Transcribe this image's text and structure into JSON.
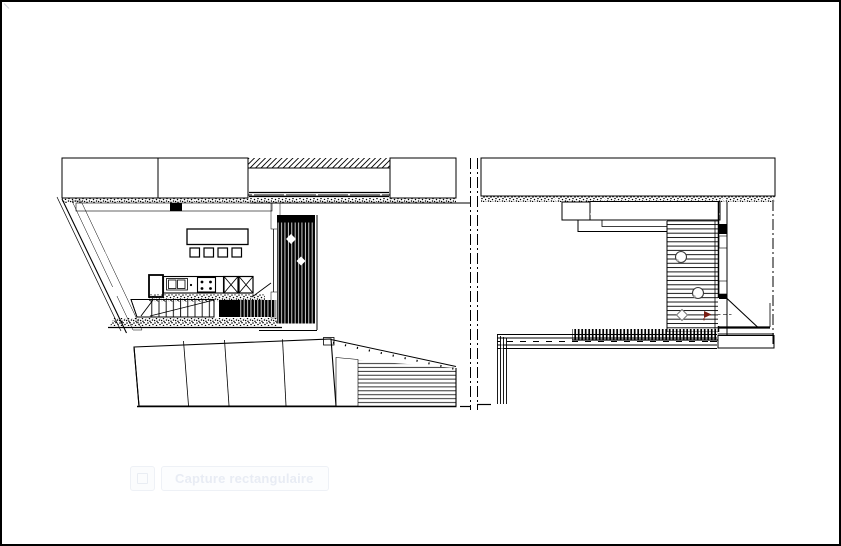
{
  "tooltip": {
    "label": "Capture rectangulaire",
    "icon": "capture-mode-icon"
  },
  "colors": {
    "paper": "#ffffff",
    "frame": "#000000",
    "ink": "#000000",
    "marker_red": "#7a1d12",
    "fixture_gray": "#7d7d7d",
    "tooltip_text": "#e8ecf4",
    "tooltip_border": "#eef1f6",
    "tooltip_fill": "#fcfdfe"
  },
  "drawing": {
    "sheets": [
      {
        "id": "left-floor-plan",
        "label": "floor plan: kitchen, dining table, stair, slatted terrace"
      },
      {
        "id": "left-roof-plan",
        "label": "roof plan: hatched slopes with decked wedge"
      },
      {
        "id": "right-floor-plan",
        "label": "plan: slatted terrace, planters, door swing, retaining wall"
      }
    ],
    "symbols": [
      "party-wall-hatching",
      "boundary-dash-dot-line",
      "stipple-masonry-wall",
      "kitchen-counter-with-sink-and-cooktop",
      "refrigerator",
      "dining-table-with-four-chairs",
      "staircase",
      "deck-boards",
      "door-swing",
      "planter-circle",
      "red-survey-arrow"
    ]
  }
}
